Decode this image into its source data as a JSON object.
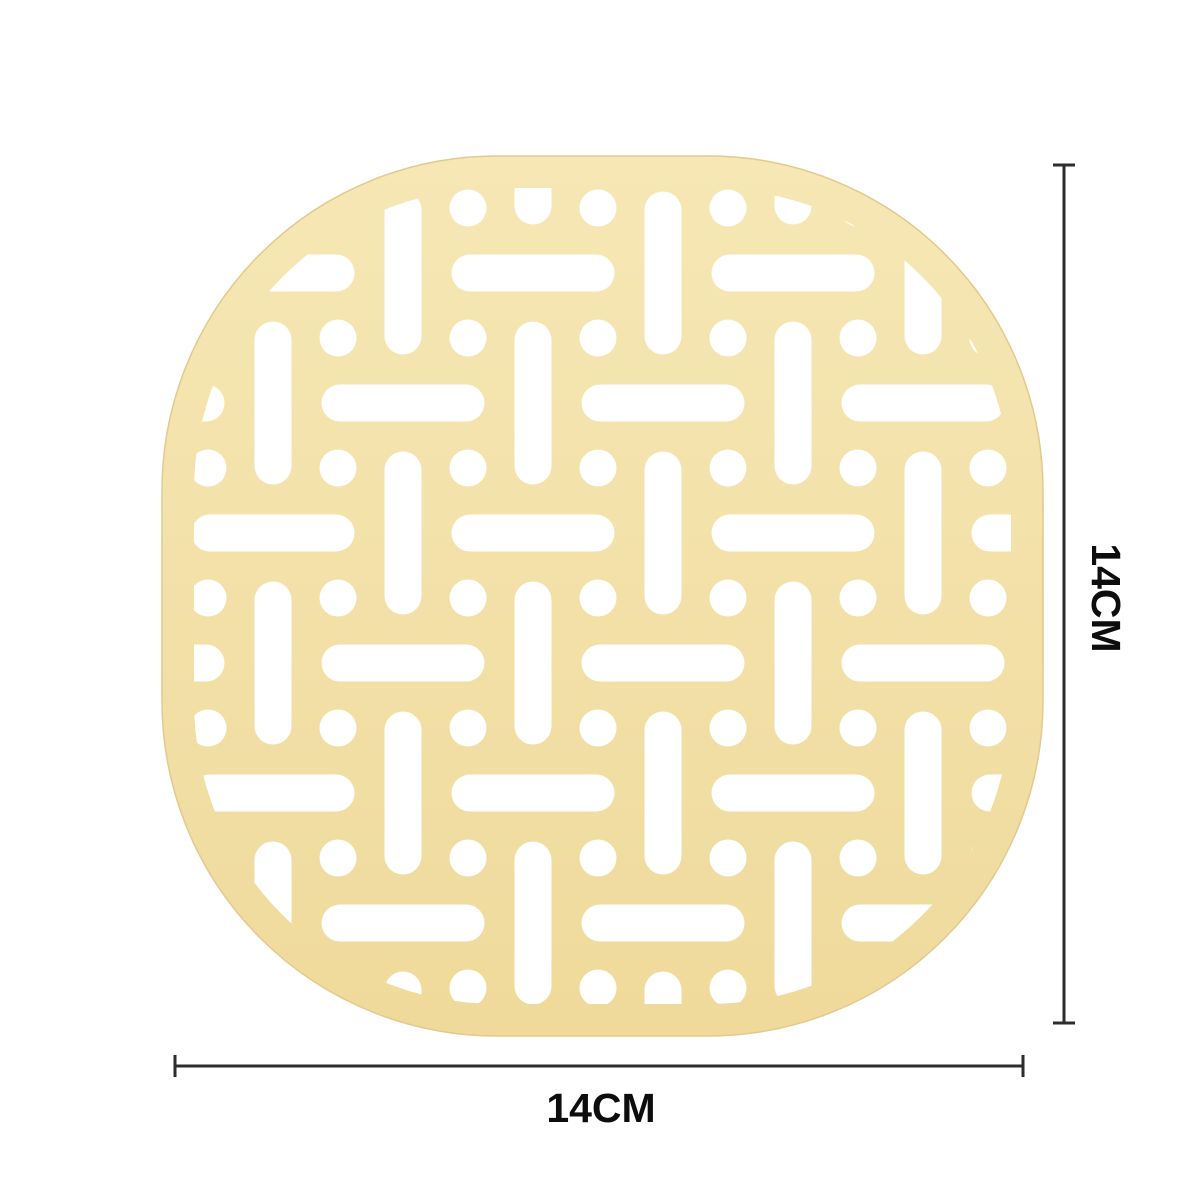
{
  "canvas": {
    "width": 1200,
    "height": 1200,
    "background_color": "#ffffff"
  },
  "mat": {
    "name": "silicone trivet mat",
    "fill_top": "#f6e7b5",
    "fill_bottom": "#efda9b",
    "edge_stroke": "#e3c98d",
    "hole_color": "#ffffff",
    "outer": {
      "x": 162,
      "y": 156,
      "width": 881,
      "height": 880,
      "radius": 335
    },
    "pattern_inset": 32,
    "pattern": {
      "grid_origin": 273,
      "grid_pitch": 65,
      "index_min": -2,
      "index_max": 12,
      "slot_length": 163,
      "slot_width": 37,
      "circle_diameter": 37
    }
  },
  "dimensions": {
    "line_color": "#2d2d2d",
    "line_width": 3,
    "cap_length": 22,
    "label_color": "#0d0d0d",
    "label_font_size": 41,
    "height": {
      "label": "14CM",
      "line_x": 1064,
      "y1": 165,
      "y2": 1023,
      "label_x": 1103,
      "label_y": 598,
      "rotation": 90
    },
    "width": {
      "label": "14CM",
      "line_y": 1066,
      "x1": 175,
      "x2": 1023,
      "label_x": 601,
      "label_y": 1122
    }
  }
}
